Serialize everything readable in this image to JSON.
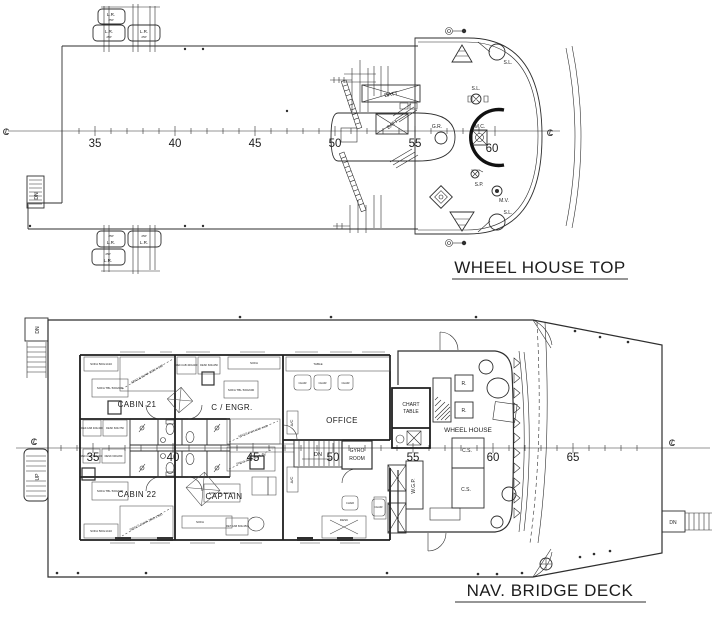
{
  "titles": {
    "wheel_house_top": "WHEEL HOUSE TOP",
    "nav_bridge_deck": "NAV. BRIDGE DECK"
  },
  "cl": {
    "c": "C",
    "l": "L"
  },
  "top_deck": {
    "frames": [
      "35",
      "40",
      "45",
      "50",
      "55",
      "60"
    ],
    "labels": {
      "life_raft": "L.R.",
      "life_raft_capacity": "25P",
      "battery": "BATT",
      "gyro_repeater": "G.R.",
      "magnetic_compass": "M.C.",
      "search_light": "S.L.",
      "signal_post": "S.P.",
      "mushroom_vent": "M.V.",
      "down": "DN"
    }
  },
  "nav_deck": {
    "frames": [
      "35",
      "40",
      "45",
      "50",
      "55",
      "60",
      "65"
    ],
    "rooms": {
      "cabin21": "CABIN 21",
      "cabin22": "CABIN 22",
      "chief_engineer": "C / ENGR.",
      "captain": "CAPTAIN",
      "office": "OFFICE",
      "chart_table_line1": "CHART",
      "chart_table_line2": "TABLE",
      "gyro_room_line1": "GYRO",
      "gyro_room_line2": "ROOM",
      "wheel_house": "WHEEL HOUSE"
    },
    "labels": {
      "down": "DN",
      "up": "UP",
      "console": "C.S.",
      "radar": "R.",
      "wgp": "W.G.P.",
      "ac": "A/C",
      "chair": "CHAIR",
      "table": "TABLE",
      "desk": "DESK",
      "sofa": "SOFA",
      "sofa_dim": "SOFA 500x1410",
      "sofa_tbl_dim": "SOFA TBL 500x600",
      "ref_cab_dim": "REF.CAB 400x400",
      "desk_dim": "DESK 600x750",
      "desk_dim2": "DESK 600x450",
      "ret_cab_dim": "RET.CAB 600x450",
      "single_bunk": "SINGLE BUNK 2000 X 800"
    }
  }
}
